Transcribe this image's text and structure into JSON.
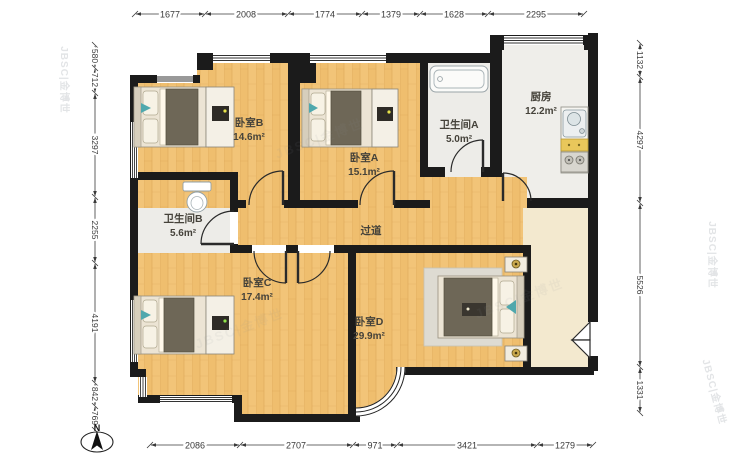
{
  "rooms": {
    "bedroom_b": {
      "name": "卧室B",
      "area": "14.6m²"
    },
    "bedroom_a": {
      "name": "卧室A",
      "area": "15.1m²"
    },
    "bath_a": {
      "name": "卫生间A",
      "area": "5.0m²"
    },
    "kitchen": {
      "name": "厨房",
      "area": "12.2m²"
    },
    "bath_b": {
      "name": "卫生间B",
      "area": "5.6m²"
    },
    "corridor": {
      "name": "过道"
    },
    "bedroom_c": {
      "name": "卧室C",
      "area": "17.4m²"
    },
    "bedroom_d": {
      "name": "卧室D",
      "area": "29.9m²"
    }
  },
  "dimensions": {
    "top": [
      "1677",
      "2008",
      "1774",
      "1379",
      "1628",
      "2295"
    ],
    "bottom": [
      "2086",
      "2707",
      "971",
      "3421",
      "1279"
    ],
    "left": [
      "580",
      "712",
      "3297",
      "2255",
      "4191",
      "842",
      "769"
    ],
    "right": [
      "1132",
      "4297",
      "5526",
      "1331"
    ]
  },
  "compass": {
    "label": "N"
  },
  "watermark": {
    "text": "JBSC|金博世"
  },
  "colors": {
    "wall": "#1b1b1b",
    "wood_floor": "#f2c478",
    "tile_floor": "#edece8",
    "foyer_floor": "#f3e9cf",
    "accent_teal": "#4fa8ad",
    "counter_yellow": "#e9c75b"
  }
}
